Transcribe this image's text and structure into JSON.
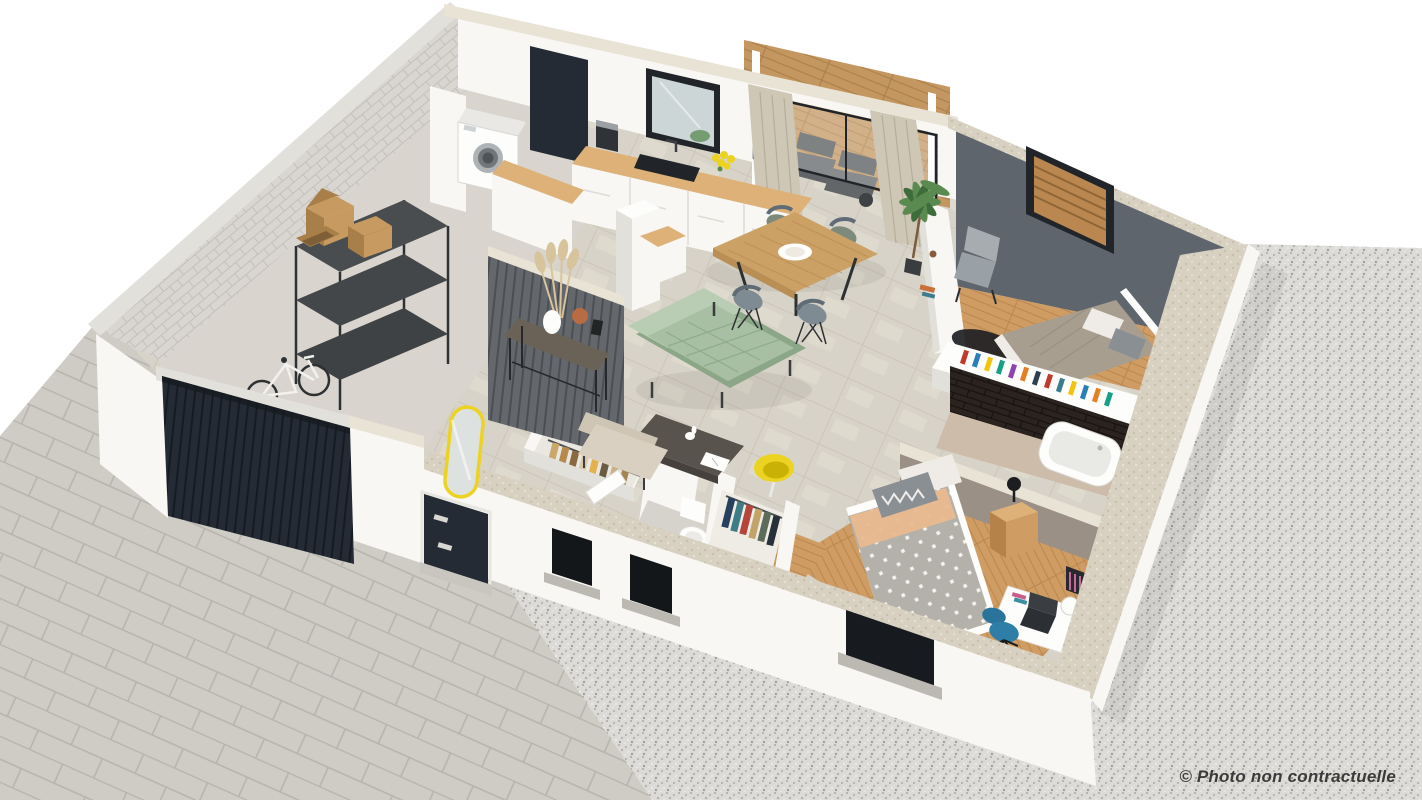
{
  "watermark": {
    "text": "© Photo non contractuelle"
  },
  "rooms": [
    "garage",
    "laundry",
    "entry-hall",
    "kitchen",
    "dining-area",
    "living-room",
    "hallway-closets",
    "wc",
    "master-bedroom",
    "bathroom",
    "bedroom",
    "terrace-deck",
    "driveway",
    "gravel-yard"
  ],
  "colors": {
    "bg": "#ffffff",
    "text": "#3b3b3b",
    "granite": "#dcdbd8",
    "granite_dot_a": "#b6b4af",
    "granite_dot_b": "#9a9892",
    "granite_dot_c": "#f0efeb",
    "paver": "#cfccc6",
    "paver_line": "#b6b3ac",
    "wall_white": "#f8f7f4",
    "wall_face": "#f1efeb",
    "wall_side": "#e2e0da",
    "cap": "#d8d1c2",
    "cap_dot": "#c6bfab",
    "cap_light": "#e9e3d5",
    "stone": "#d9d6d1",
    "stone_line": "#c3c0b9",
    "navy": "#242b34",
    "navy_line": "#151b23",
    "tile": "#d8d3c8",
    "tile_line": "#c7bfaf",
    "tile_light": "#e5dfd3",
    "wood": "#cf9c63",
    "wood_line": "#b5824a",
    "wood_top": "#ddb178",
    "deck": "#c49760",
    "deck_line": "#a97e49",
    "gray_wall": "#5e656d",
    "frame": "#212529",
    "glass": "#ccd6d6",
    "brick": "#2b2320",
    "brick_line": "#171210",
    "slat": "#64686d",
    "slat_line": "#4b4f54",
    "concrete": "#d9d5ce",
    "sofa": "#a8bfa3",
    "sofa_dark": "#8ca788",
    "sofa_light": "#b9ccb4",
    "table_wood": "#cba165",
    "chair": "#7e8b93",
    "chair_dark": "#5f6c76",
    "chair_green": "#7d8a7b",
    "bed_taupe": "#a89e90",
    "pillow": "#efece7",
    "pillow_gray": "#8a8f94",
    "duvet": "#b4b1aa",
    "peach": "#e9b98f",
    "white_obj": "#fdfdfc",
    "yellow": "#ecd321",
    "blue": "#2e7ea8",
    "plant": "#5a8a50",
    "plant_dark": "#3e6c3a",
    "terracotta": "#b96b44",
    "pampas": "#d8c49c",
    "box": "#c69a60",
    "box_side": "#a87e49",
    "metal": "#2e3134",
    "rug": "#1e2023",
    "curtain": "#cec7b5",
    "curtain_line": "#b4ad9a",
    "console": "#6b6257",
    "taupe_wall": "#9b9086",
    "bath_floor": "#cdbca9"
  }
}
